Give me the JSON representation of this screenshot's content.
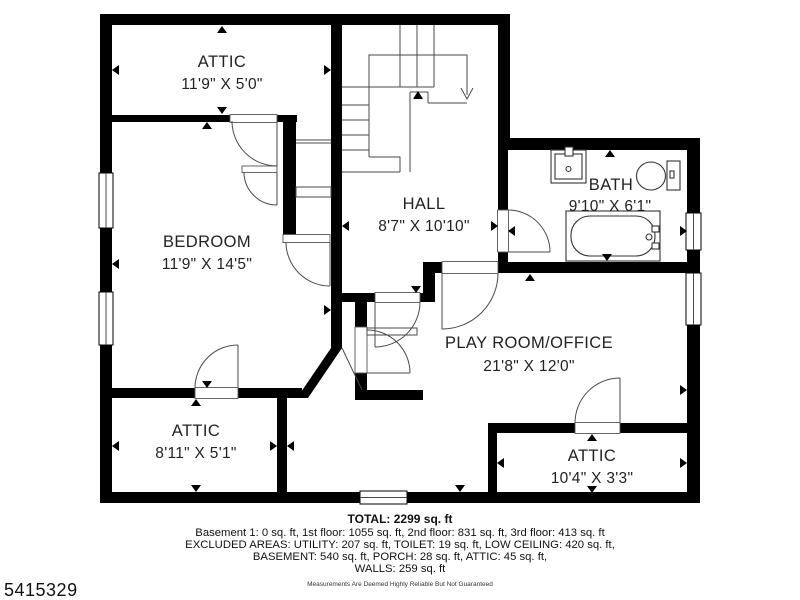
{
  "plan_id": "5415329",
  "rooms": [
    {
      "name": "ATTIC",
      "dims": "11'9\" X 5'0\""
    },
    {
      "name": "BEDROOM",
      "dims": "11'9\" X 14'5\""
    },
    {
      "name": "HALL",
      "dims": "8'7\" X 10'10\""
    },
    {
      "name": "BATH",
      "dims": "9'10\" X 6'1\""
    },
    {
      "name": "PLAY ROOM/OFFICE",
      "dims": "21'8\" X 12'0\""
    },
    {
      "name": "ATTIC",
      "dims": "8'11\" X 5'1\""
    },
    {
      "name": "ATTIC",
      "dims": "10'4\" X 3'3\""
    }
  ],
  "footer": {
    "total": "TOTAL: 2299 sq. ft",
    "breakdown": "Basement 1: 0 sq. ft, 1st floor: 1055 sq. ft, 2nd floor: 831 sq. ft, 3rd floor: 413 sq. ft",
    "excluded1": "EXCLUDED AREAS: UTILITY: 207 sq. ft, TOILET: 19 sq. ft, LOW CEILING: 420 sq. ft,",
    "excluded2": "BASEMENT: 540 sq. ft, PORCH: 28 sq. ft, ATTIC: 45 sq. ft,",
    "excluded3": "WALLS: 259 sq. ft",
    "disclaimer": "Measurements Are Deemed Highly Reliable But Not Guaranteed"
  },
  "colors": {
    "walls": "#000000",
    "background": "#ffffff",
    "text": "#222222"
  }
}
